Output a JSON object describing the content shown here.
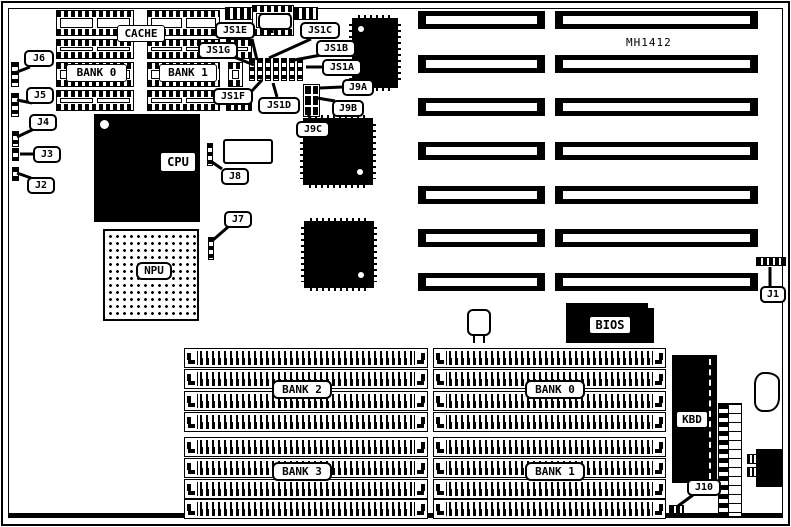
{
  "board": {
    "model": "MH1412"
  },
  "labels": {
    "cache": "CACHE",
    "tag": "TAG",
    "cache_bank0": "BANK 0",
    "cache_bank1": "BANK 1",
    "cpu": "CPU",
    "npu": "NPU",
    "bios": "BIOS",
    "kbd": "KBD"
  },
  "simm_banks": {
    "bank2": "BANK 2",
    "bank3": "BANK 3",
    "bank0": "BANK 0",
    "bank1": "BANK 1"
  },
  "callouts": {
    "j1": "J1",
    "j2": "J2",
    "j3": "J3",
    "j4": "J4",
    "j5": "J5",
    "j6": "J6",
    "j7": "J7",
    "j8": "J8",
    "j9a": "J9A",
    "j9b": "J9B",
    "j9c": "J9C",
    "j10": "J10",
    "js1a": "JS1A",
    "js1b": "JS1B",
    "js1c": "JS1C",
    "js1d": "JS1D",
    "js1e": "JS1E",
    "js1f": "JS1F",
    "js1g": "JS1G"
  }
}
